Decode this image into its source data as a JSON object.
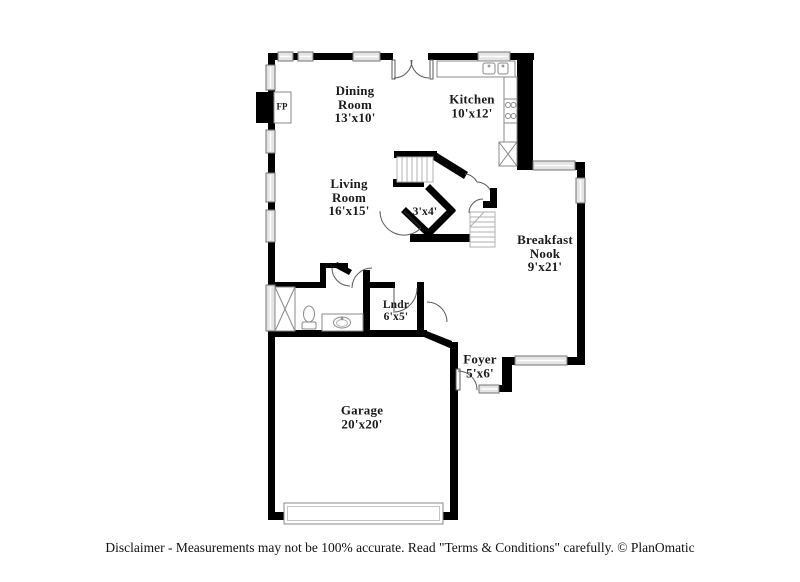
{
  "colors": {
    "wall": "#000000",
    "window_fill": "#e4e4e4",
    "window_stroke": "#737373",
    "door_stroke": "#5a5a5a",
    "stair_stroke": "#b0b0b0",
    "fixture_stroke": "#8a8a8a",
    "trim_stroke": "#c4c4c4",
    "label": "#1b1b1b"
  },
  "rooms": {
    "dining": {
      "lines": [
        "Dining",
        "Room",
        "13'x10'"
      ]
    },
    "kitchen": {
      "lines": [
        "Kitchen",
        "10'x12'"
      ]
    },
    "living": {
      "lines": [
        "Living",
        "Room",
        "16'x15'"
      ]
    },
    "breakfast": {
      "lines": [
        "Breakfast",
        "Nook",
        "9'x21'"
      ]
    },
    "laundry": {
      "lines": [
        "Lndr",
        "6'x5'"
      ]
    },
    "foyer": {
      "lines": [
        "Foyer",
        "5'x6'"
      ]
    },
    "garage": {
      "lines": [
        "Garage",
        "20'x20'"
      ]
    },
    "powder": {
      "lines": [
        "3'x4'"
      ]
    },
    "closet": {
      "lines": [
        "3'x2'"
      ]
    },
    "fireplace": {
      "lines": [
        "FP"
      ]
    }
  },
  "footer": {
    "disclaimer": "Disclaimer - Measurements may not be 100% accurate. Read \"Terms & Conditions\" carefully. © PlanOmatic"
  }
}
